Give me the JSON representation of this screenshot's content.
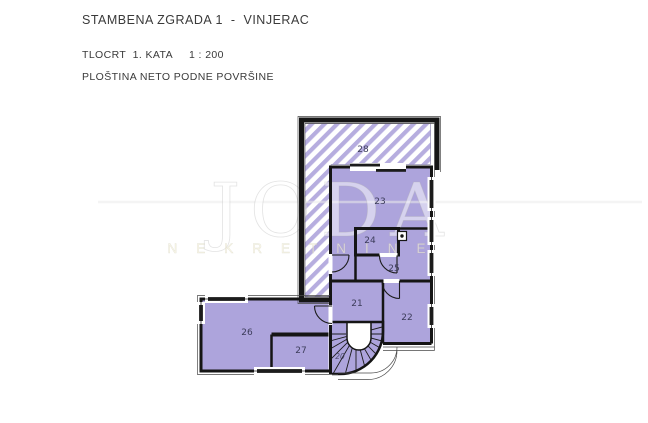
{
  "header": {
    "title": "STAMBENA ZGRADA 1  -  VINJERAC",
    "subtitle": "TLOCRT  1. KATA     1 : 200",
    "note": "PLOŠTINA NETO PODNE POVRŠINE"
  },
  "watermark": {
    "brand": "JODA",
    "tagline": "NEKRETNINE"
  },
  "plan": {
    "rooms": {
      "r20": {
        "label": "20",
        "type": "spiral-staircase"
      },
      "r21": {
        "label": "21",
        "type": "room"
      },
      "r22": {
        "label": "22",
        "type": "room"
      },
      "r23": {
        "label": "23",
        "type": "room"
      },
      "r24": {
        "label": "24",
        "type": "room"
      },
      "r25": {
        "label": "25",
        "type": "room"
      },
      "r26": {
        "label": "26",
        "type": "room"
      },
      "r27": {
        "label": "27",
        "type": "room"
      },
      "r28": {
        "label": "28",
        "type": "terrace-hatched"
      }
    }
  },
  "colors": {
    "room_fill": "#ada4dc",
    "hatch_stripe": "#b6addf",
    "wall": "#151515",
    "label_text": "#3c3c5a",
    "header_text": "#3a3a3a",
    "background": "#ffffff"
  }
}
